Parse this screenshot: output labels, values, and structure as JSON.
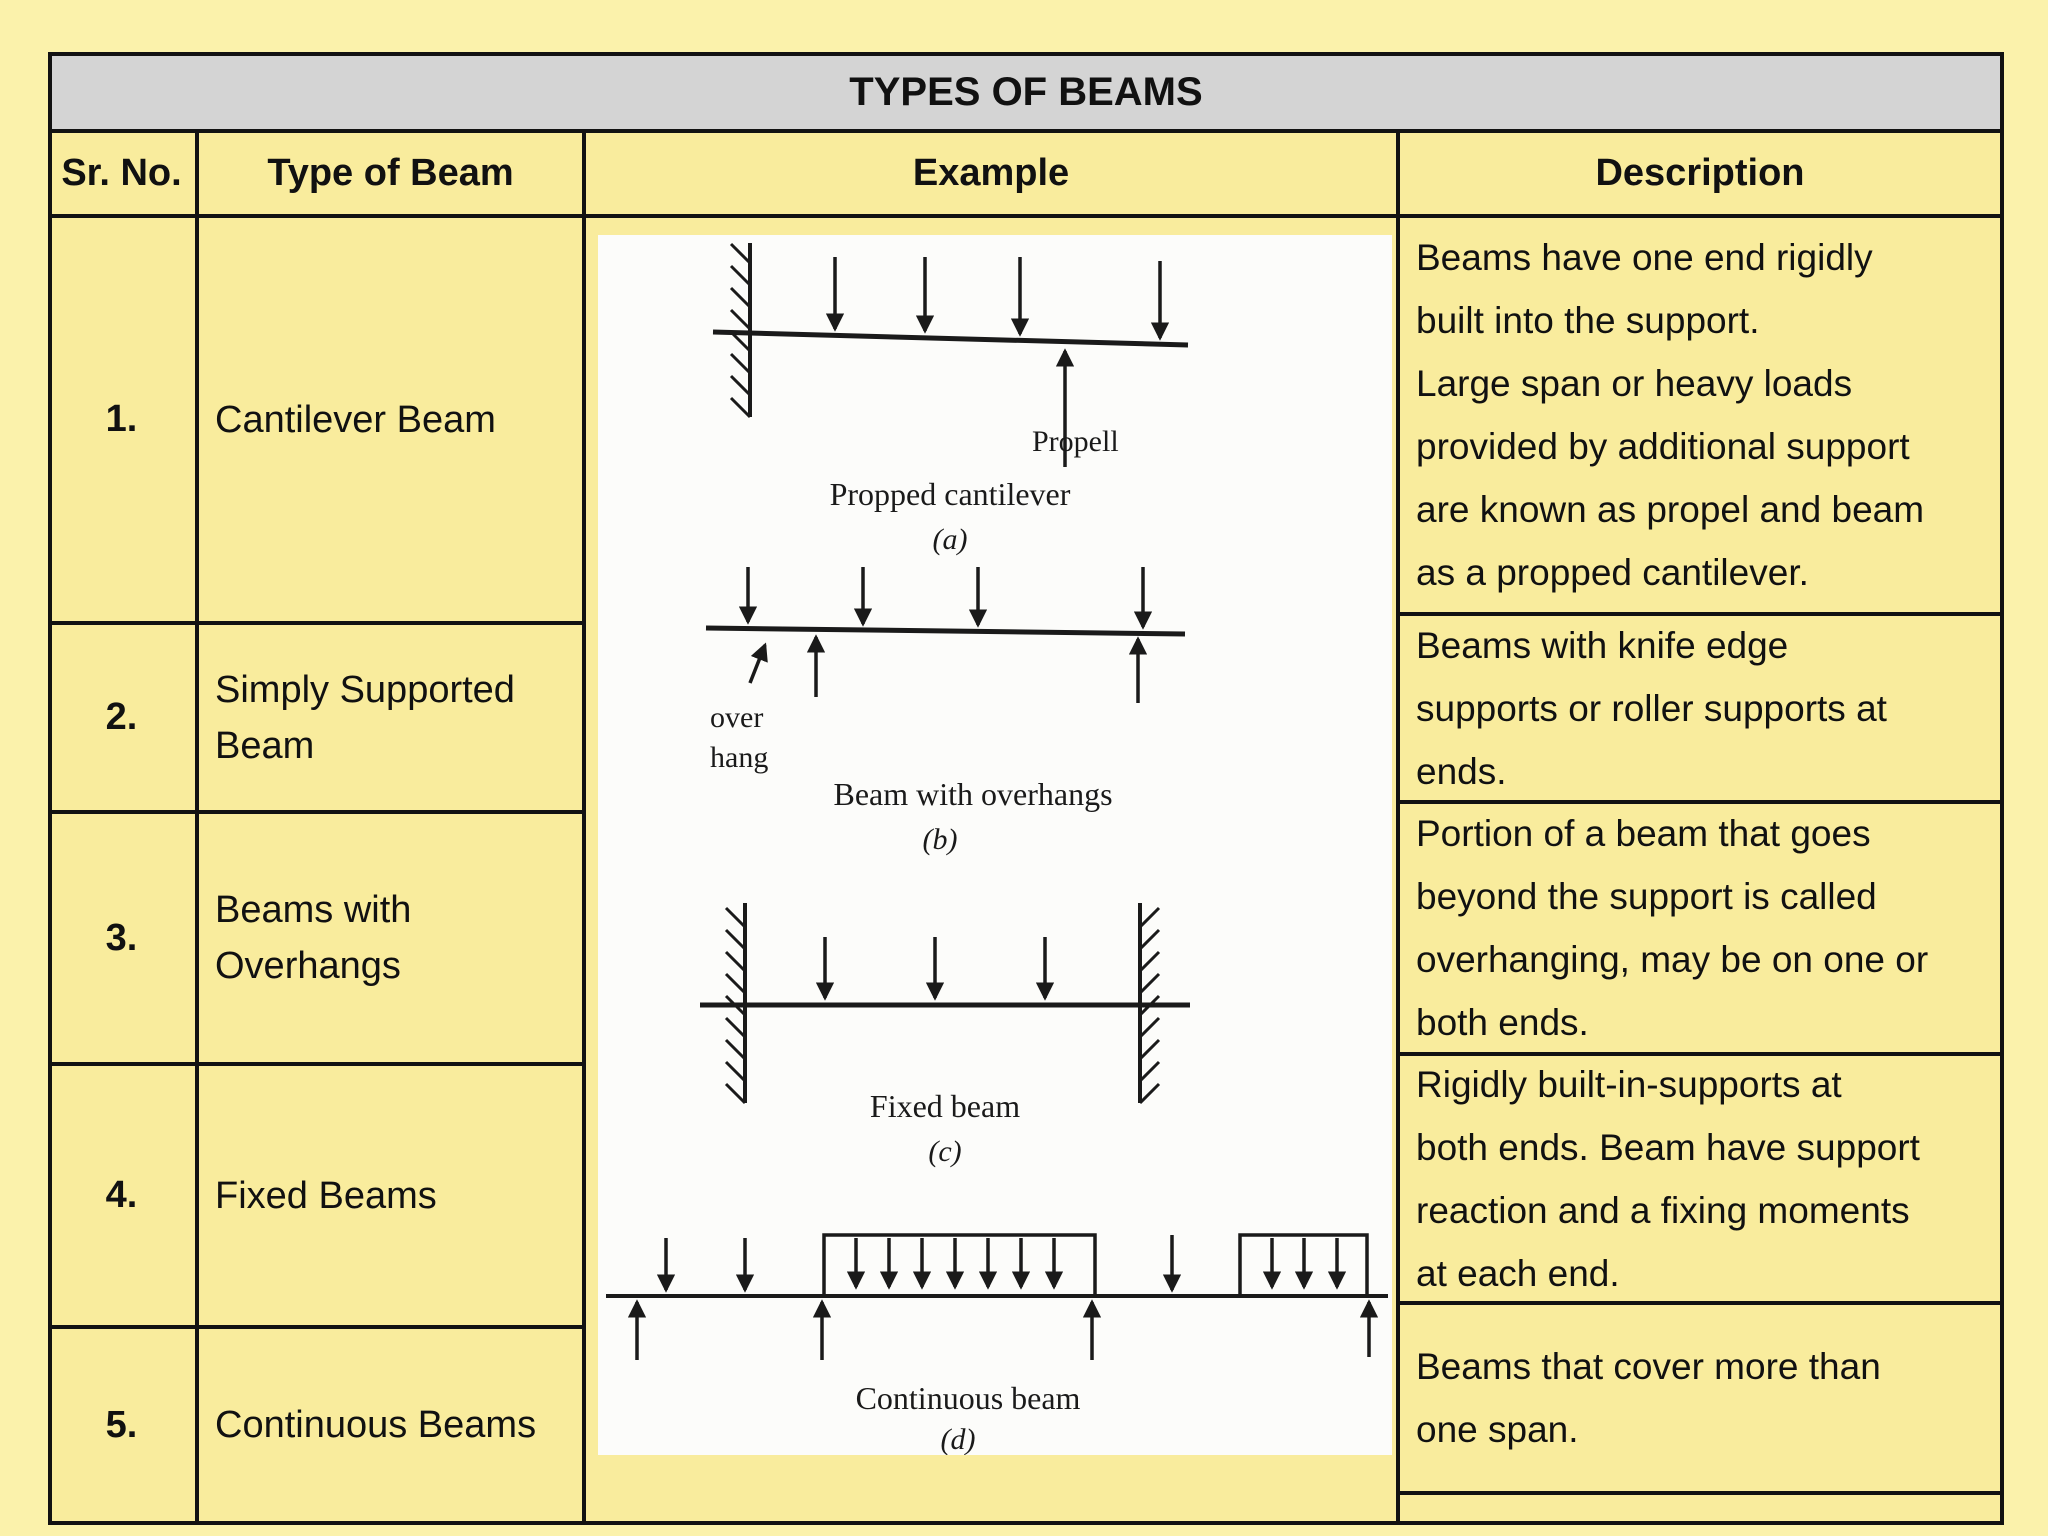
{
  "title": "TYPES OF BEAMS",
  "columns": [
    "Sr. No.",
    "Type of Beam",
    "Example",
    "Description"
  ],
  "rows": [
    {
      "sr": "1.",
      "type": "Cantilever Beam",
      "description": "Beams have one end rigidly\nbuilt into the support.\nLarge span or heavy loads\nprovided by additional support\nare known as propel and beam\nas a propped cantilever."
    },
    {
      "sr": "2.",
      "type": "Simply Supported\nBeam",
      "description": "Beams with knife edge\nsupports or roller supports at\nends."
    },
    {
      "sr": "3.",
      "type": "Beams with\nOverhangs",
      "description": "Portion of a beam that goes\nbeyond the support is called\noverhanging, may be on one or\nboth ends."
    },
    {
      "sr": "4.",
      "type": "Fixed Beams",
      "description": "Rigidly built-in-supports at\nboth ends. Beam have support\nreaction and a fixing moments\nat each end."
    },
    {
      "sr": "5.",
      "type": "Continuous Beams",
      "description": "Beams that cover more than\none span."
    }
  ],
  "figures": {
    "a": {
      "prop_label": "Propell",
      "caption": "Propped cantilever",
      "tag": "(a)"
    },
    "b": {
      "overhang_line1": "over",
      "overhang_line2": "hang",
      "caption": "Beam with overhangs",
      "tag": "(b)"
    },
    "c": {
      "caption": "Fixed beam",
      "tag": "(c)"
    },
    "d": {
      "caption": "Continuous beam",
      "tag": "(d)"
    }
  },
  "colors": {
    "page_bg": "#fbf2ab",
    "table_bg": "#f9ec9d",
    "title_bg": "#d4d4d4",
    "line": "#121212",
    "ink": "#111111",
    "panel_bg": "#fcfcfa"
  }
}
